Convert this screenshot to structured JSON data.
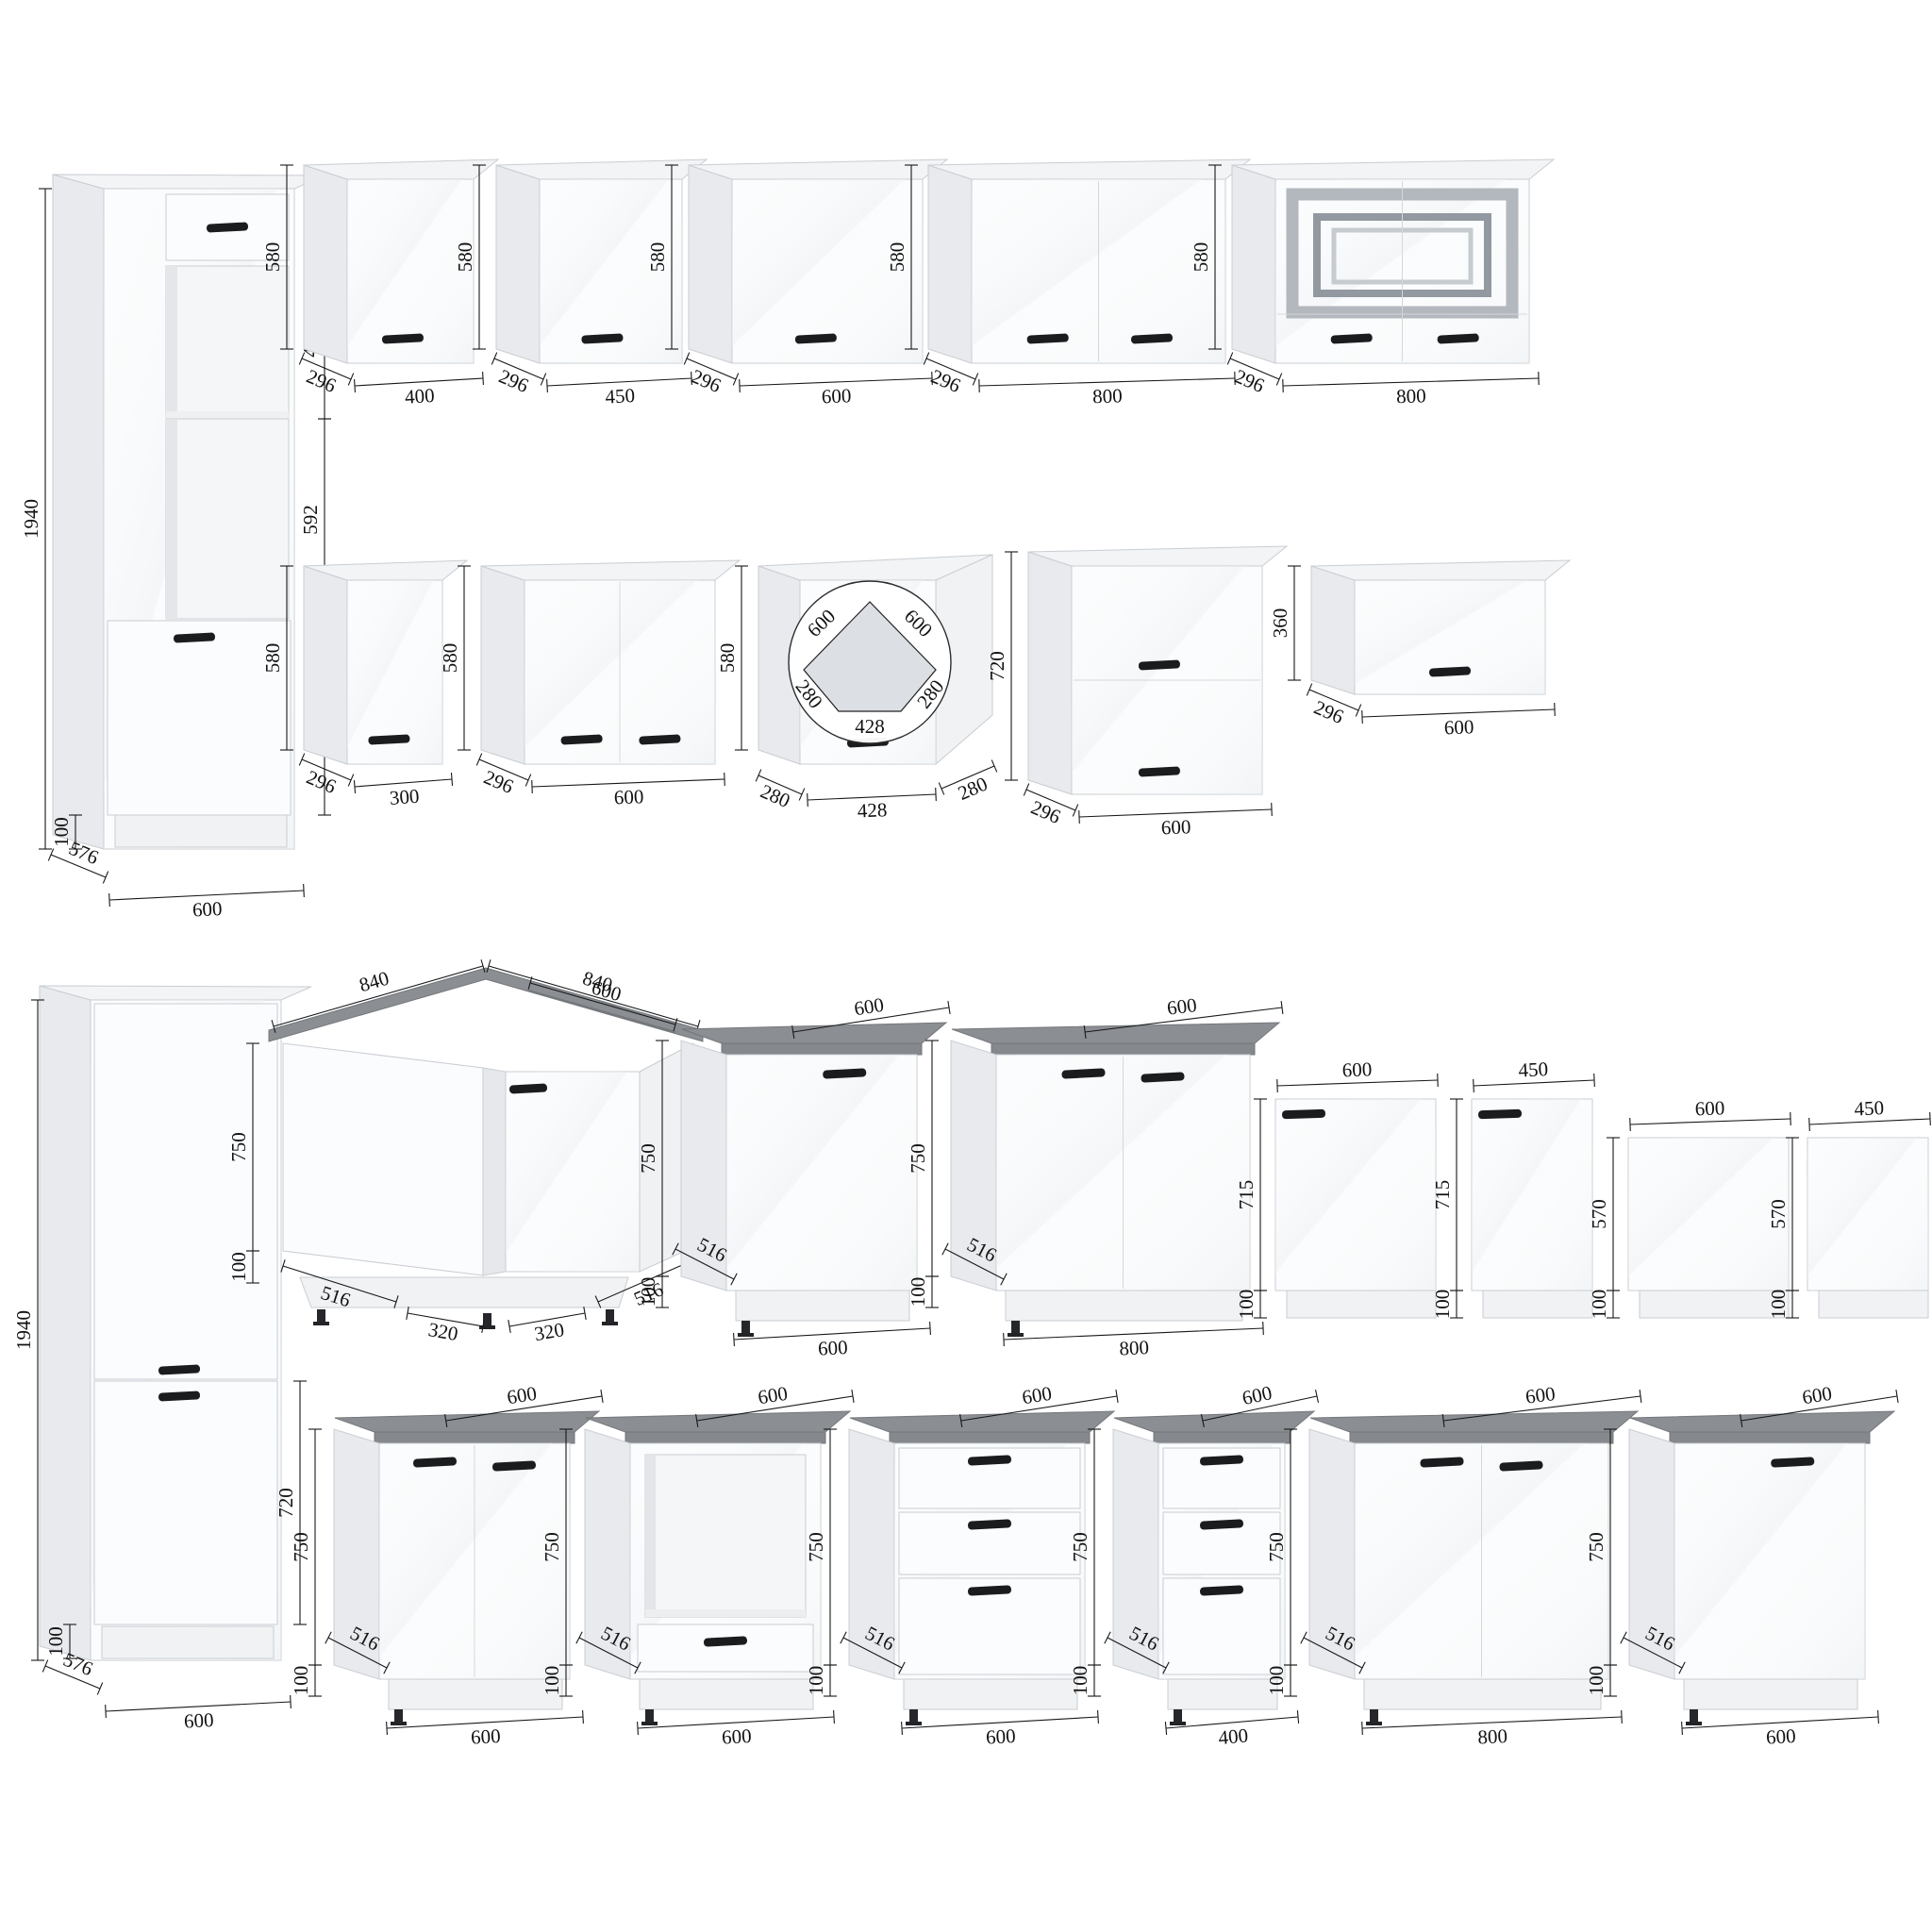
{
  "colors": {
    "worktop": "#8b8e92",
    "handle": "#1b1c1e",
    "cabinet_front": "#fbfcfd",
    "cabinet_side": "#e8eaed",
    "dimension_line": "#17181a"
  },
  "cabinets": [
    {
      "id": "tall-oven-housing-600",
      "dims": {
        "height": "1940",
        "section_top": "450",
        "section_middle": "592",
        "section_bottom": "570",
        "plinth": "100",
        "depth": "576",
        "width": "600"
      }
    },
    {
      "id": "wall-cabinet-400",
      "dims": {
        "height": "580",
        "depth": "296",
        "width": "400"
      }
    },
    {
      "id": "wall-cabinet-450",
      "dims": {
        "height": "580",
        "depth": "296",
        "width": "450"
      }
    },
    {
      "id": "wall-cabinet-600",
      "dims": {
        "height": "580",
        "depth": "296",
        "width": "600"
      }
    },
    {
      "id": "wall-cabinet-800-two-door",
      "dims": {
        "height": "580",
        "depth": "296",
        "width": "800"
      }
    },
    {
      "id": "wall-cabinet-800-glass",
      "dims": {
        "height": "580",
        "depth": "296",
        "width": "800"
      }
    },
    {
      "id": "wall-cabinet-300",
      "dims": {
        "height": "580",
        "depth": "296",
        "width": "300"
      }
    },
    {
      "id": "wall-cabinet-600-two-door",
      "dims": {
        "height": "580",
        "depth": "296",
        "width": "600"
      }
    },
    {
      "id": "wall-cabinet-corner",
      "dims": {
        "height": "580",
        "left_return": "280",
        "front": "428",
        "right_return": "280",
        "plan_left": "600",
        "plan_right": "600",
        "plan_left_side": "280",
        "plan_front": "428",
        "plan_right_side": "280"
      }
    },
    {
      "id": "wall-cabinet-600-h720",
      "dims": {
        "height": "720",
        "depth": "296",
        "width": "600"
      }
    },
    {
      "id": "wall-cabinet-600-h360",
      "dims": {
        "height": "360",
        "depth": "296",
        "width": "600"
      }
    },
    {
      "id": "tall-fridge-housing-600",
      "dims": {
        "height": "1940",
        "lower_section": "720",
        "plinth": "100",
        "depth": "576",
        "width": "600"
      }
    },
    {
      "id": "base-cabinet-corner",
      "dims": {
        "top_left": "840",
        "top_right": "840",
        "top_inner": "600",
        "height": "750",
        "plinth": "100",
        "bottom_left": "516",
        "bottom_left_inner": "320",
        "bottom_right_inner": "320",
        "bottom_right": "516"
      }
    },
    {
      "id": "base-cabinet-600-door",
      "dims": {
        "worktop_depth": "600",
        "height": "750",
        "depth": "516",
        "plinth": "100",
        "width": "600"
      }
    },
    {
      "id": "base-cabinet-800-two-door",
      "dims": {
        "worktop_depth": "600",
        "height": "750",
        "depth": "516",
        "plinth": "100",
        "width": "800"
      }
    },
    {
      "id": "front-panel-600-tall",
      "dims": {
        "width": "600",
        "height": "715",
        "plinth": "100"
      }
    },
    {
      "id": "front-panel-450-tall",
      "dims": {
        "width": "450",
        "height": "715",
        "plinth": "100"
      }
    },
    {
      "id": "front-panel-600-short",
      "dims": {
        "width": "600",
        "height": "570",
        "plinth": "100"
      }
    },
    {
      "id": "front-panel-450-short",
      "dims": {
        "width": "450",
        "height": "570",
        "plinth": "100"
      }
    },
    {
      "id": "base-cabinet-600-two-door",
      "dims": {
        "worktop_depth": "600",
        "height": "750",
        "depth": "516",
        "plinth": "100",
        "width": "600"
      }
    },
    {
      "id": "base-cabinet-600-oven",
      "dims": {
        "worktop_depth": "600",
        "height": "750",
        "depth": "516",
        "plinth": "100",
        "width": "600"
      }
    },
    {
      "id": "base-cabinet-600-drawers",
      "dims": {
        "worktop_depth": "600",
        "height": "750",
        "depth": "516",
        "plinth": "100",
        "width": "600"
      }
    },
    {
      "id": "base-cabinet-400-drawers",
      "dims": {
        "worktop_depth": "600",
        "height": "750",
        "depth": "516",
        "plinth": "100",
        "width": "400"
      }
    },
    {
      "id": "base-cabinet-800-two-door-b",
      "dims": {
        "worktop_depth": "600",
        "height": "750",
        "depth": "516",
        "plinth": "100",
        "width": "800"
      }
    },
    {
      "id": "base-cabinet-600-door-b",
      "dims": {
        "worktop_depth": "600",
        "height": "750",
        "depth": "516",
        "plinth": "100",
        "width": "600"
      }
    }
  ]
}
